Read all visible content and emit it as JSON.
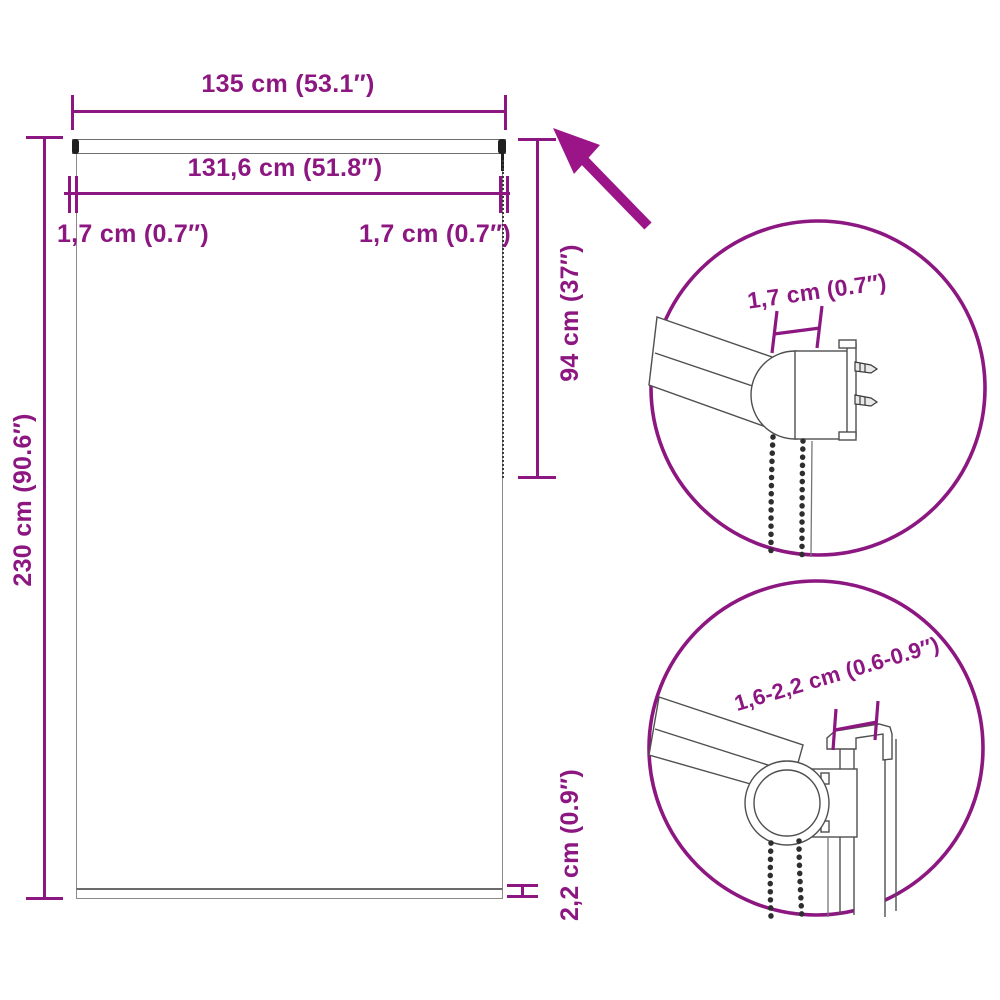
{
  "colors": {
    "accent": "#8D1781",
    "arrow": "#9B1588",
    "drawing_outline": "#4f4f4f",
    "fabric_outline": "#8c8c8c",
    "end_cap_dark": "#1f1f1f",
    "background": "#ffffff"
  },
  "main_view": {
    "labels": {
      "total_width": "135 cm (53.1″)",
      "fabric_width": "131,6 cm (51.8″)",
      "offset_left": "1,7 cm (0.7″)",
      "offset_right": "1,7 cm (0.7″)",
      "height": "230 cm (90.6″)",
      "chain_length": "94 cm (37″)",
      "bottom_bar_height": "2,2 cm (0.9″)"
    }
  },
  "detail_views": {
    "top": {
      "label": "1,7 cm (0.7″)"
    },
    "bottom": {
      "label": "1,6-2,2 cm (0.6-0.9″)"
    }
  }
}
